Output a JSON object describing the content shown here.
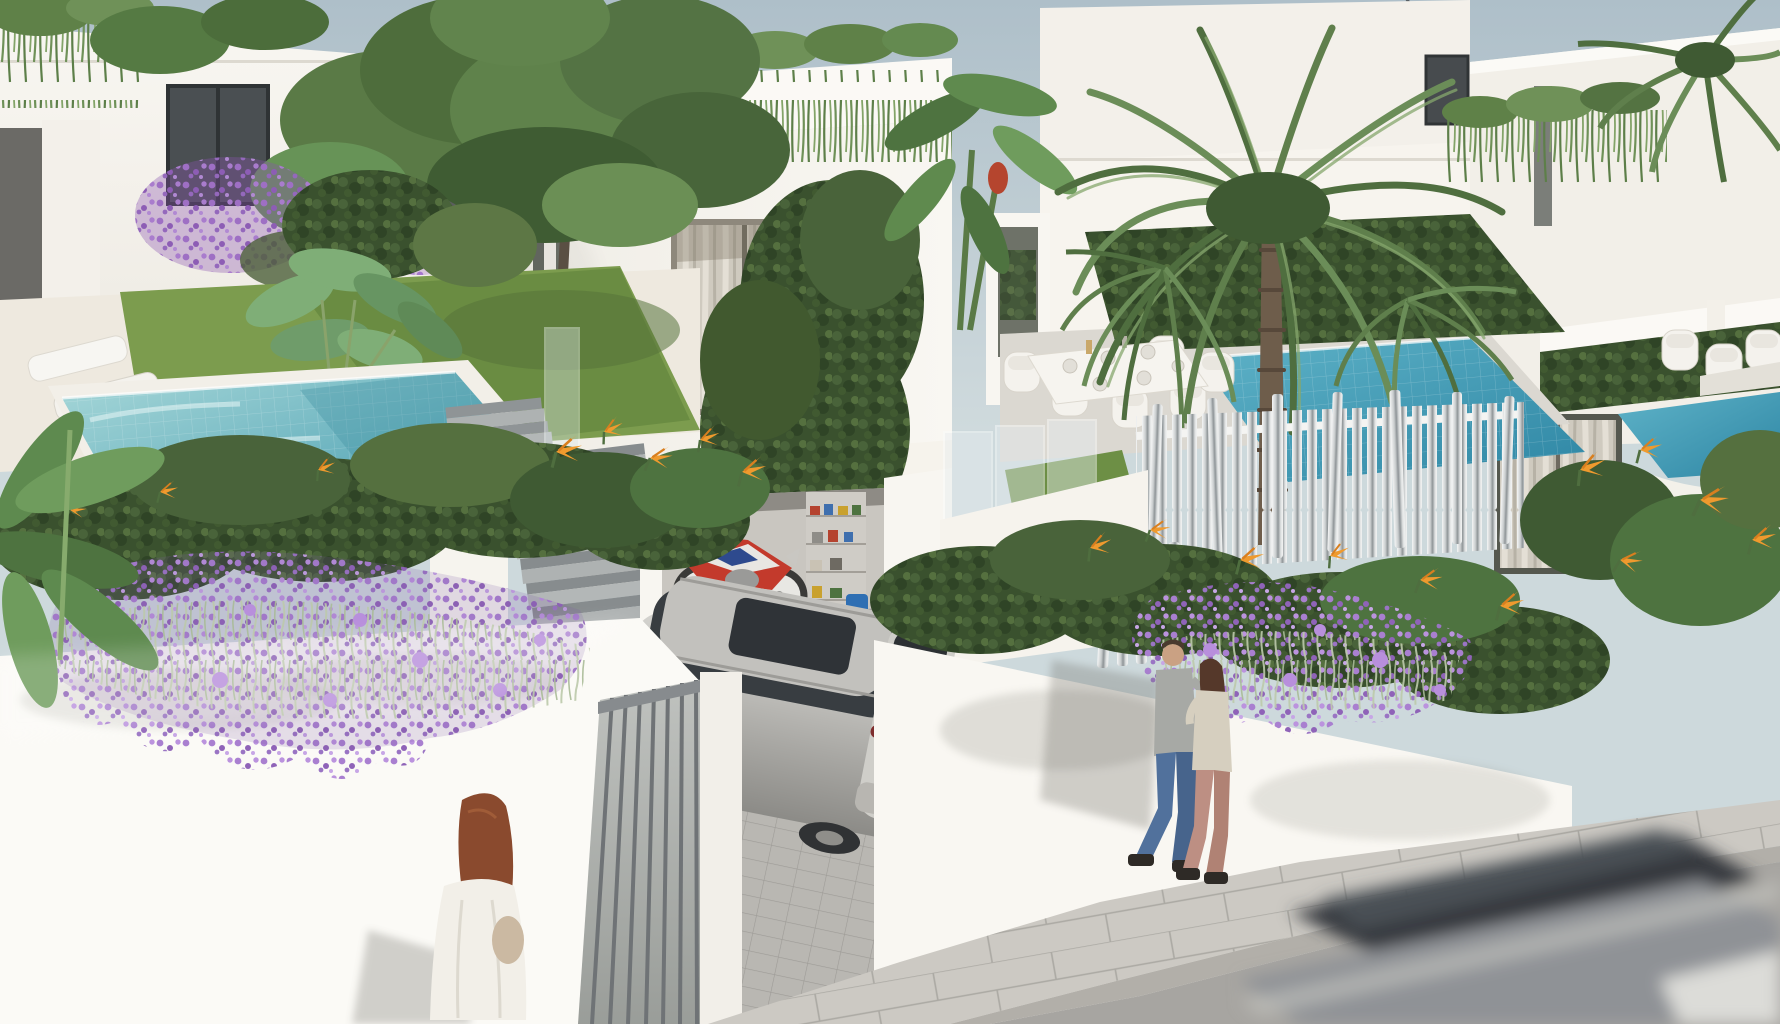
{
  "scene": {
    "title": "3D exterior render of modern white villas with pools",
    "license_plate": {
      "text": "ANH 7852"
    },
    "palette": {
      "sky_top": "#aebfc9",
      "sky_horizon": "#cfdadd",
      "wall_white": "#f8f6f1",
      "wall_shade": "#e6e2da",
      "deck_cream": "#eee9df",
      "pool_light": "#9ed3d6",
      "pool_deep": "#2e86a4",
      "foliage_dark": "#3c5230",
      "foliage_mid": "#5d7f49",
      "foliage_light": "#83a468",
      "flower_purple": "#a97fd0",
      "flower_orange": "#ef9a2e",
      "bougainvillea": "#a06cc0",
      "pavement": "#ccc9c3",
      "road": "#a7a5a1",
      "stair_gray": "#9aa0a2",
      "suv_silver": "#b9b8b3",
      "motorcycle_red": "#c33a2c",
      "taillight_red": "#a33434",
      "plate_band_blue": "#2b4f9e",
      "hair_auburn": "#8a4a2e",
      "jeans_blue": "#51719c",
      "pants_pink": "#bd8f83",
      "chrome_fence": "#c8cccd",
      "curtain": "#d8d3c8",
      "window_glass": "#41464a"
    },
    "objects": [
      "white modern villas",
      "left swimming pool",
      "right swimming pool",
      "large palm tree",
      "garden tree",
      "hanging roof plants",
      "purple flower cascades",
      "bird of paradise flowers",
      "stairs to street",
      "garage with red motorcycle and shelves",
      "silver SUV on driveway",
      "metal pedestrian gate",
      "chrome picket fence",
      "outdoor dining set",
      "sun loungers",
      "woman in white walking",
      "couple walking on sidewalk",
      "motion blurred passing car",
      "power line"
    ]
  }
}
